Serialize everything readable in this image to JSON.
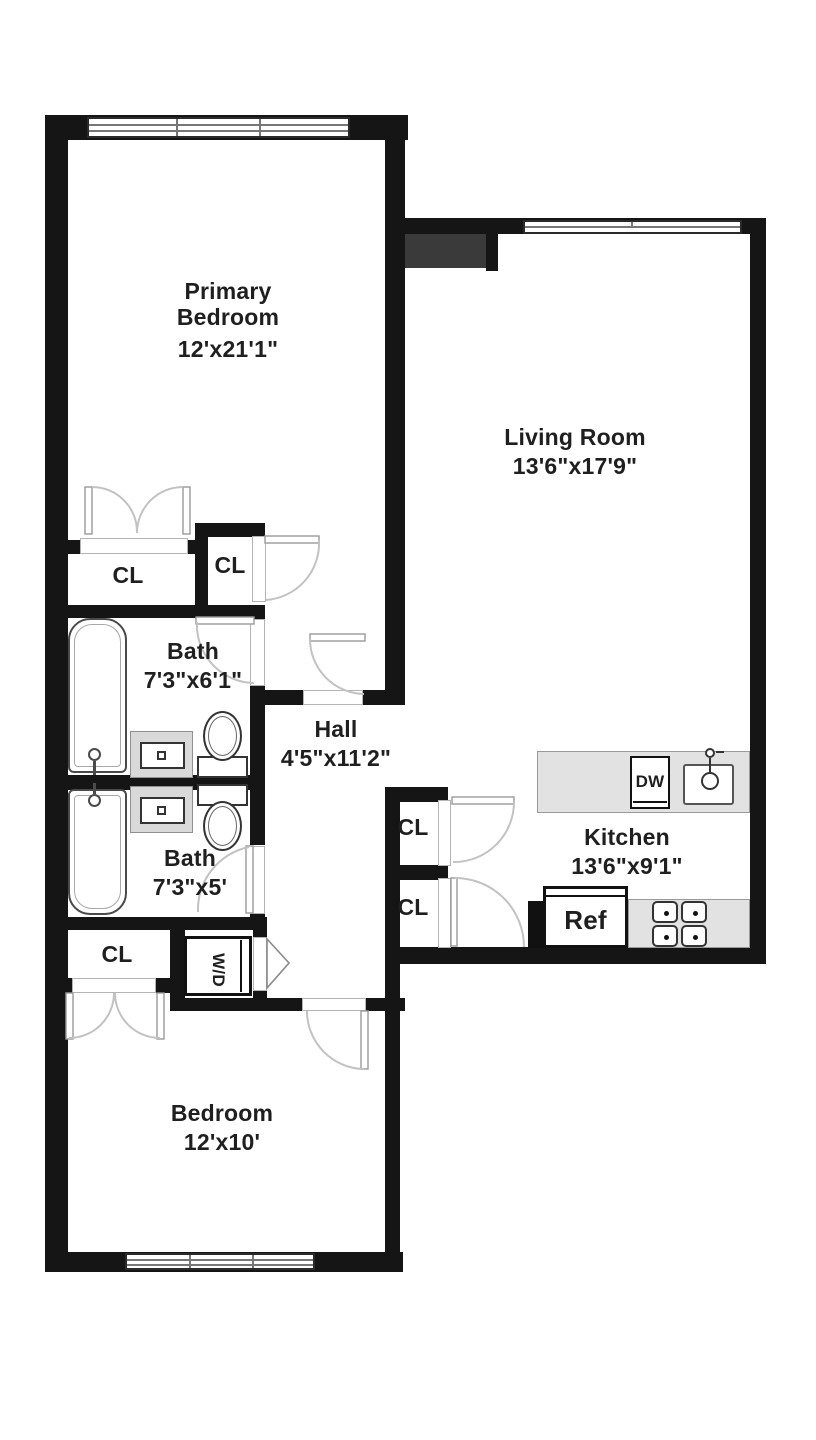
{
  "floorplan": {
    "rooms": {
      "primary_bedroom": {
        "name_line1": "Primary",
        "name_line2": "Bedroom",
        "dims": "12'x21'1\""
      },
      "living_room": {
        "name": "Living Room",
        "dims": "13'6\"x17'9\""
      },
      "bath_1": {
        "name": "Bath",
        "dims": "7'3\"x6'1\""
      },
      "hall": {
        "name": "Hall",
        "dims": "4'5\"x11'2\""
      },
      "bath_2": {
        "name": "Bath",
        "dims": "7'3\"x5'"
      },
      "kitchen": {
        "name": "Kitchen",
        "dims": "13'6\"x9'1\""
      },
      "bedroom": {
        "name": "Bedroom",
        "dims": "12'x10'"
      }
    },
    "closets": {
      "primary_closet": "CL",
      "suite_closet": "CL",
      "kitchen_closet_upper": "CL",
      "kitchen_closet_lower": "CL",
      "bedroom_closet": "CL"
    },
    "appliances": {
      "washer_dryer": "W/D",
      "dishwasher": "DW",
      "refrigerator": "Ref"
    },
    "colors": {
      "wall": "#151515",
      "entry_shadow": "#3a3a3a",
      "counter": "#e2e2e2",
      "vanity": "#d9d9d9",
      "text": "#1f1f1f",
      "door_arc": "#c2c2c2"
    }
  }
}
